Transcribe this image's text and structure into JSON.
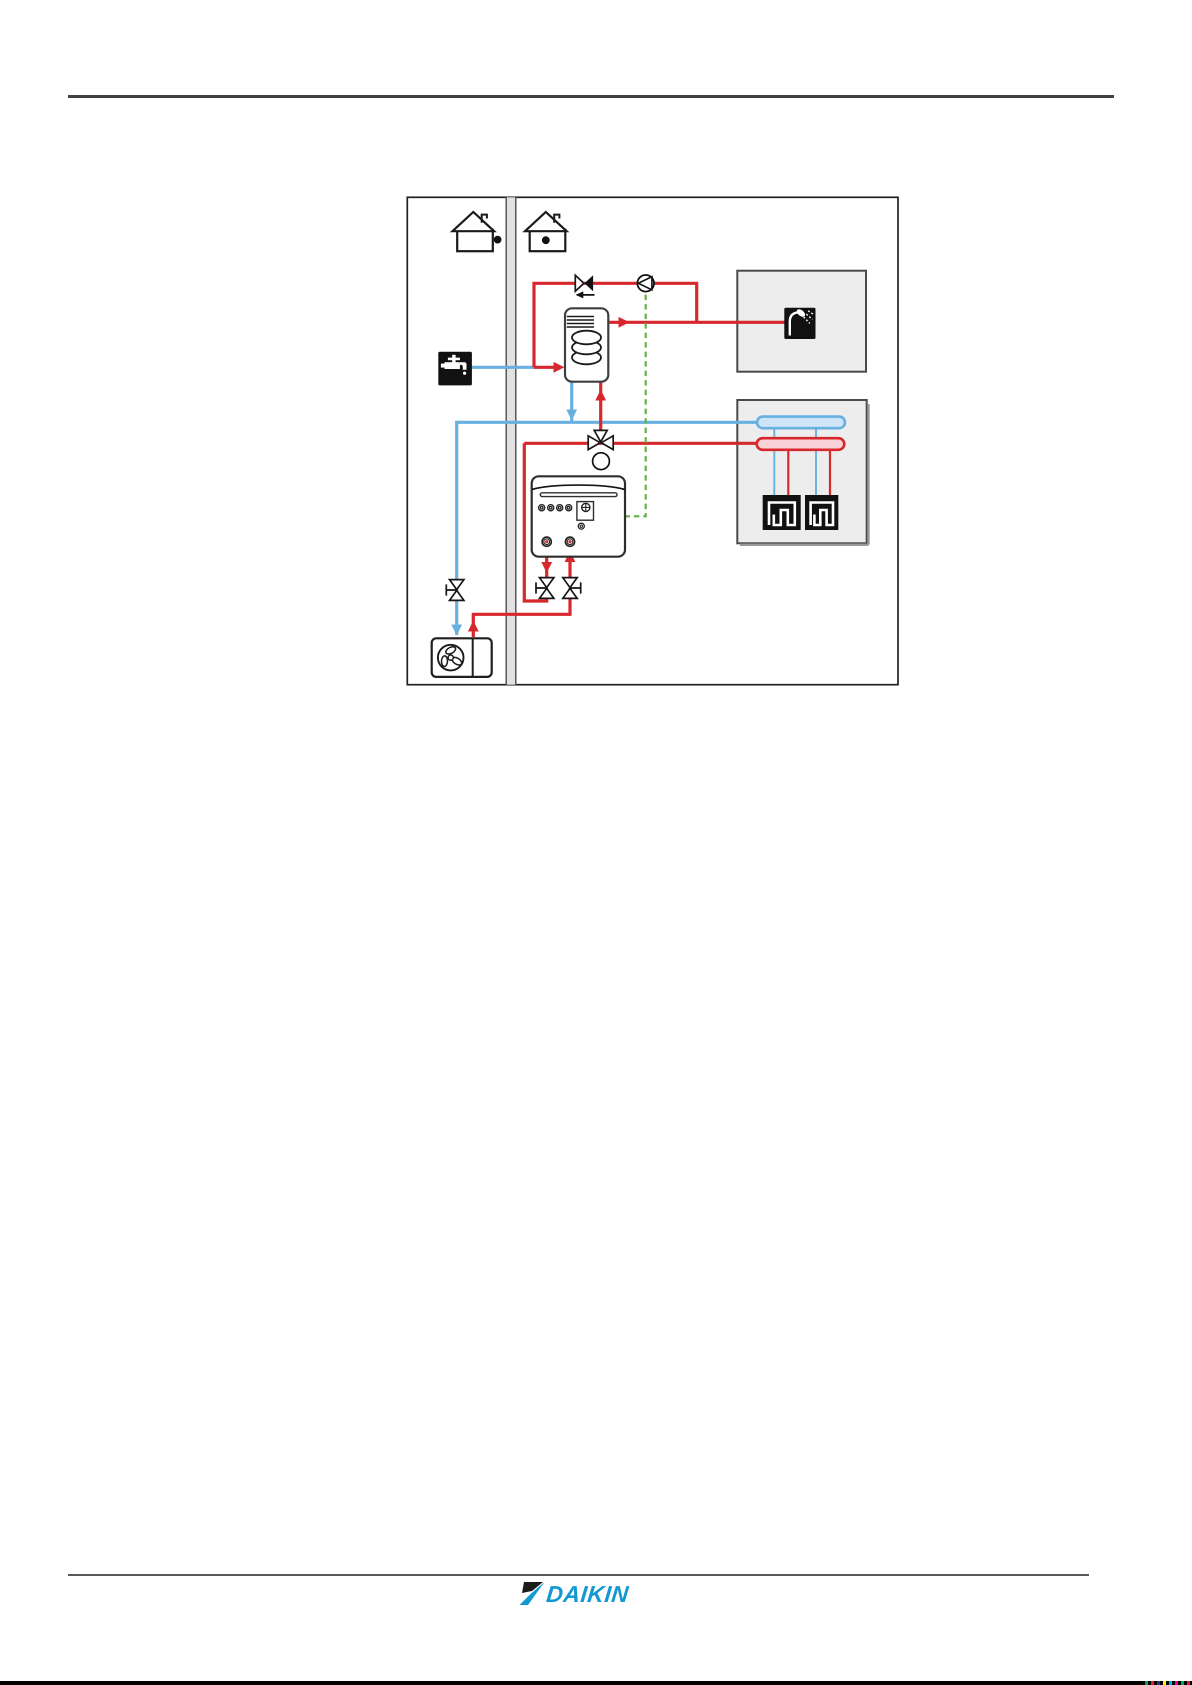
{
  "page": {
    "kind": "manual-page",
    "background": "#ffffff"
  },
  "header": {
    "rule_present": true
  },
  "footer": {
    "brand_logo_text": "DAIKIN",
    "print_marks": [
      "#00a651",
      "#ed1c24",
      "#2e3192",
      "#fff200",
      "#00aeef",
      "#ec008c",
      "#00a651",
      "#ed1c24"
    ]
  },
  "colors": {
    "hot": "#d7282e",
    "cold": "#67b0e0",
    "control": "#62b446",
    "outline": "#231f20",
    "panel_fill": "#ededee",
    "panel_border": "#4a4a4b",
    "wall_fill": "#e2e2e2",
    "manifold_hot_fill": "#f8d2d6",
    "manifold_cold_fill": "#cfe4f6",
    "rule_dark": "#414042",
    "rule_light": "#58595b",
    "brand_blue": "#1398d2"
  },
  "diagram": {
    "zones": [
      {
        "id": "outdoor",
        "icon": "house-dot-outside-icon"
      },
      {
        "id": "indoor",
        "icon": "house-dot-inside-icon"
      }
    ],
    "components": [
      "cold-water-faucet",
      "dhw-tank-with-coil",
      "check-valve",
      "recirculation-pump",
      "shower",
      "three-way-valve",
      "indoor-unit",
      "shutoff-valve-left",
      "shutoff-valve-right",
      "stop-valve",
      "outdoor-unit-fan",
      "underfloor-manifold-return",
      "underfloor-manifold-flow",
      "underfloor-loop-1",
      "underfloor-loop-2"
    ],
    "icons": [
      "house-outdoor-icon",
      "house-indoor-icon",
      "faucet-icon",
      "shower-icon",
      "fan-icon",
      "pump-icon",
      "check-valve-icon",
      "three-way-valve-icon",
      "shutoff-valve-icon",
      "underfloor-loop-icon"
    ]
  }
}
